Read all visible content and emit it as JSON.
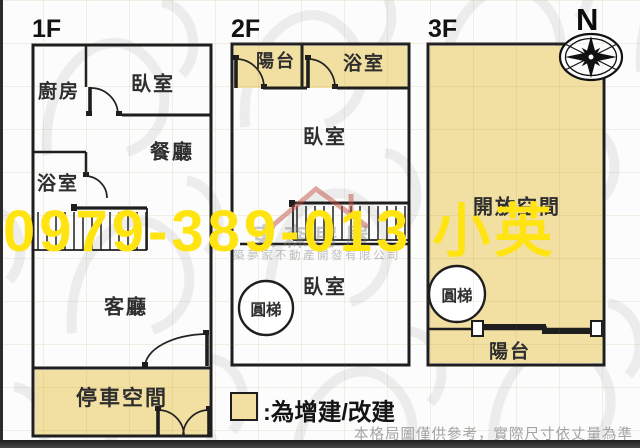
{
  "floors": [
    {
      "label": "1F",
      "rooms": [
        {
          "name": "廚房"
        },
        {
          "name": "臥室"
        },
        {
          "name": "餐廳"
        },
        {
          "name": "浴室"
        },
        {
          "name": "客廳"
        },
        {
          "name": "停車空間"
        }
      ]
    },
    {
      "label": "2F",
      "rooms": [
        {
          "name": "陽台"
        },
        {
          "name": "浴室"
        },
        {
          "name": "臥室"
        },
        {
          "name": "臥室"
        },
        {
          "name": "圓梯"
        }
      ]
    },
    {
      "label": "3F",
      "rooms": [
        {
          "name": "開放空間"
        },
        {
          "name": "圓梯"
        },
        {
          "name": "陽台"
        }
      ]
    }
  ],
  "compass": {
    "label": "N"
  },
  "legend": {
    "label": ":為增建/改建"
  },
  "disclaimer": "本格局圖僅供參考，實際尺寸依丈量為準",
  "watermarks": {
    "phone": "0979-389-013 小英",
    "brand": "東森房屋",
    "company": "築夢家不動產開發有限公司"
  },
  "colors": {
    "highlight": "#f2dfa2",
    "phone_yellow": "#ffe412",
    "wall": "#1e1e1e"
  }
}
